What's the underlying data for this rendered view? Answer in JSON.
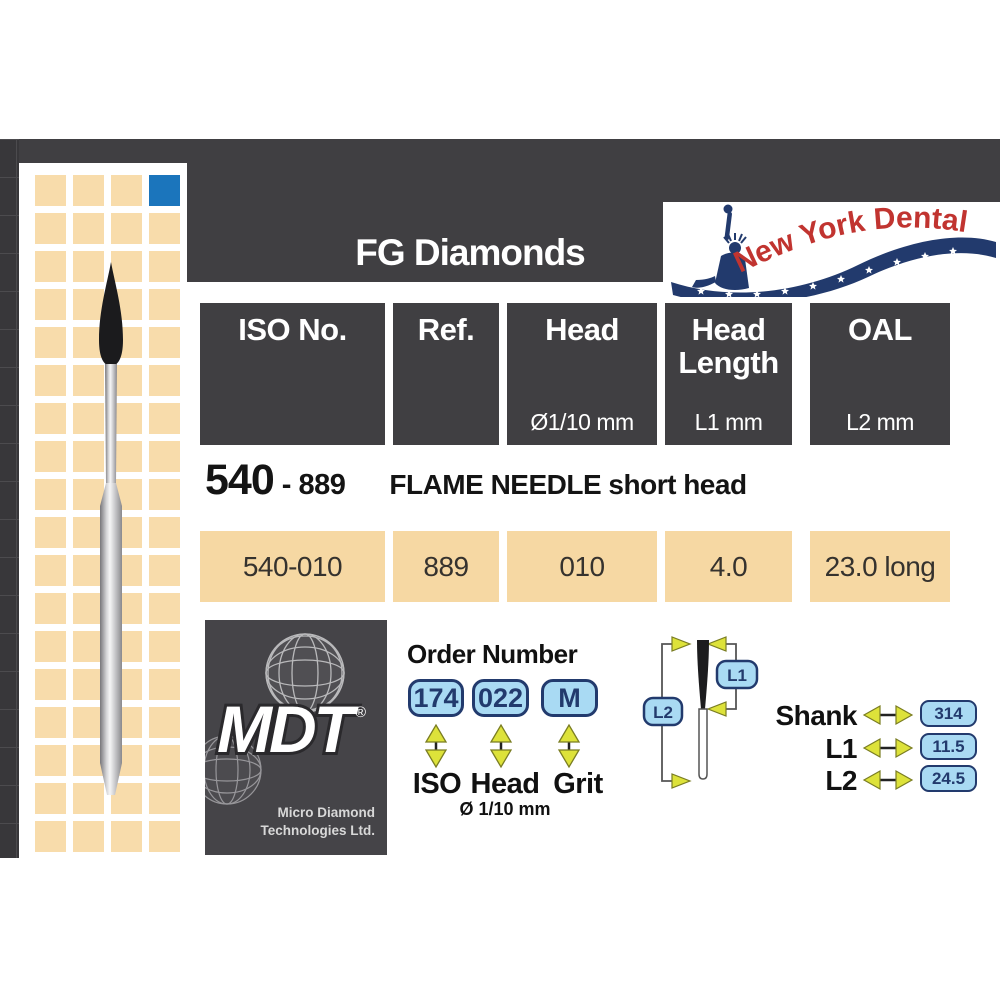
{
  "header": {
    "category": "FG Diamonds",
    "brand": "New York Dental"
  },
  "spec_table": {
    "columns": [
      {
        "l1": "ISO No.",
        "l2": "",
        "sub": ""
      },
      {
        "l1": "Ref.",
        "l2": "",
        "sub": ""
      },
      {
        "l1": "Head",
        "l2": "",
        "sub": "Ø1/10 mm"
      },
      {
        "l1": "Head",
        "l2": "Length",
        "sub": "L1 mm"
      },
      {
        "l1": "OAL",
        "l2": "",
        "sub": "L2 mm"
      }
    ],
    "product": {
      "series": "540",
      "dash_ref": "- 889",
      "name": "FLAME NEEDLE short head"
    },
    "values": [
      "540-010",
      "889",
      "010",
      "4.0",
      "23.0 long"
    ]
  },
  "mdt": {
    "wordmark": "MDT",
    "registered": "®",
    "company_line1": "Micro Diamond",
    "company_line2": "Technologies Ltd."
  },
  "order_number": {
    "title": "Order Number",
    "iso": {
      "value": "174",
      "label": "ISO"
    },
    "head": {
      "value": "022",
      "label": "Head",
      "sub": "Ø 1/10 mm"
    },
    "grit": {
      "value": "M",
      "label": "Grit"
    }
  },
  "dimensions": {
    "l1_tag": "L1",
    "l2_tag": "L2",
    "rows": [
      {
        "label": "Shank",
        "value": "314"
      },
      {
        "label": "L1",
        "value": "11.5"
      },
      {
        "label": "L2",
        "value": "24.5"
      }
    ]
  },
  "colors": {
    "card_dark": "#403f42",
    "tan": "#f6d8a3",
    "blue_square": "#1b75bc",
    "badge_blue": "#a9daf3",
    "badge_navy": "#223a6d",
    "arrow_yellow": "#dde23a",
    "logo_red": "#c13430"
  }
}
